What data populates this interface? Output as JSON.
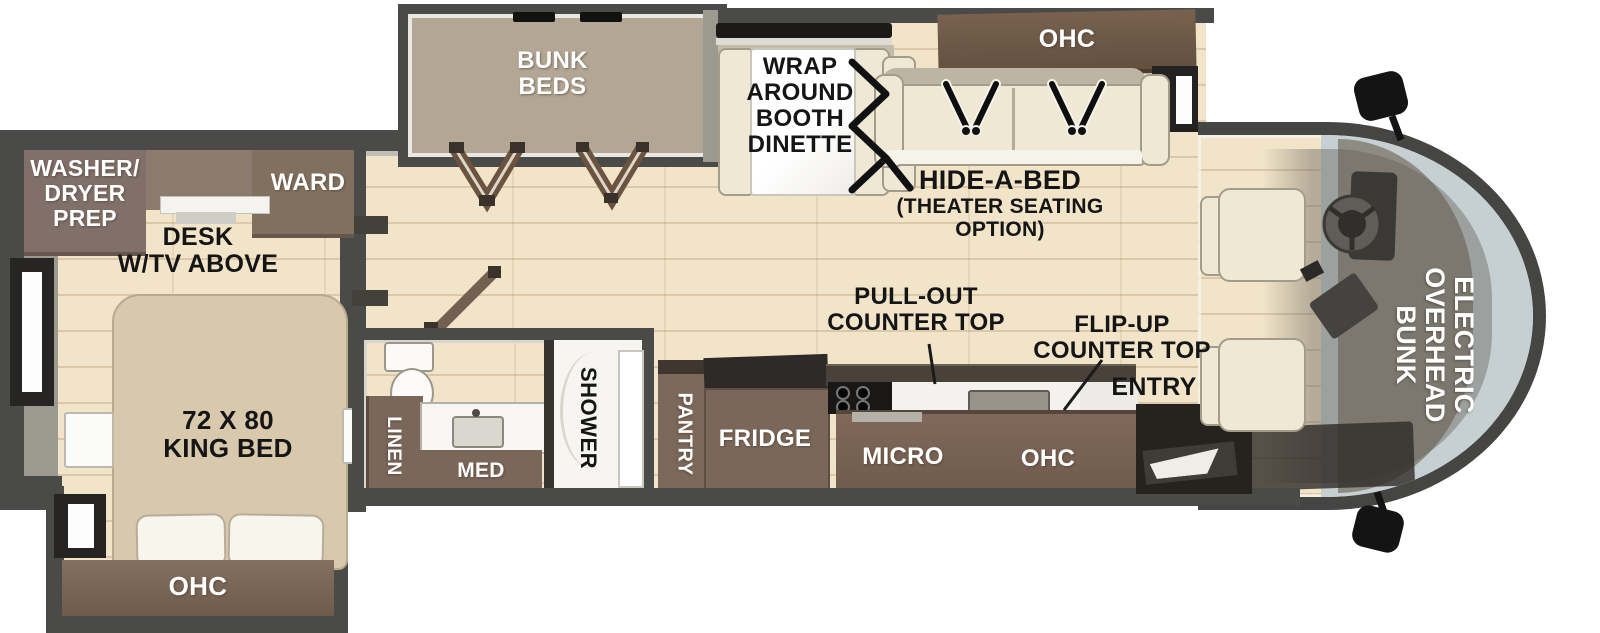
{
  "colors": {
    "wall": "#4a4a48",
    "wall-light": "#9c998f",
    "floor": "#f1e4c9",
    "brown": "#8a7668",
    "brown-dark": "#6d5848",
    "brown-mid": "#7b675a",
    "cream": "#efe8d4",
    "bed": "#d8c8ac",
    "taupe": "#b3a695",
    "marble": "#fbfbfa",
    "glass": "#c6d0d3",
    "dash": "#8e8b82",
    "dark": "#22201e",
    "ink": "#151515"
  },
  "bedroom": {
    "washer_dryer": "WASHER/\nDRYER\nPREP",
    "ward": "WARD",
    "desk": "DESK\nW/TV ABOVE",
    "king_bed": "72 X 80\nKING BED",
    "ohc": "OHC"
  },
  "bunkhouse": {
    "bunk_beds": "BUNK\nBEDS"
  },
  "dinette": {
    "wrap_around": "WRAP\nAROUND\nBOOTH\nDINETTE"
  },
  "living_area": {
    "ohc": "OHC",
    "hide_a_bed_title": "HIDE-A-BED",
    "hide_a_bed_sub": "(THEATER SEATING\nOPTION)"
  },
  "kitchen": {
    "pull_out": "PULL-OUT\nCOUNTER TOP",
    "flip_up": "FLIP-UP\nCOUNTER TOP",
    "entry": "ENTRY",
    "pantry": "PANTRY",
    "fridge": "FRIDGE",
    "micro": "MICRO",
    "ohc": "OHC"
  },
  "bathroom": {
    "linen": "LINEN",
    "med": "MED",
    "shower": "SHOWER"
  },
  "cab": {
    "overhead_bunk": "ELECTRIC\nOVERHEAD\nBUNK"
  }
}
